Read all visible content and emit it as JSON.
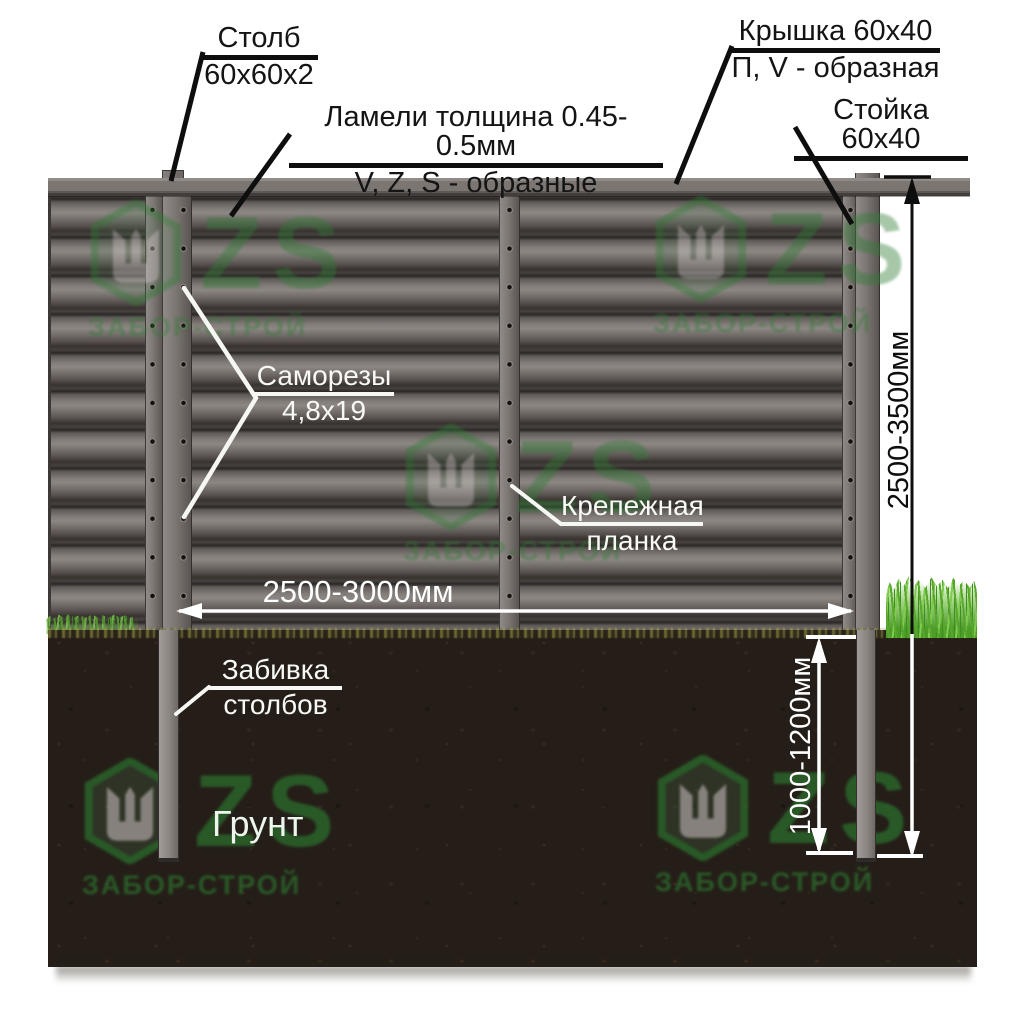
{
  "labels": {
    "stolb": {
      "line1": "Столб",
      "line2": "60х60х2"
    },
    "lameli": {
      "line1": "Ламели толщина 0.45-0.5мм",
      "line2": "V, Z, S - образные"
    },
    "kryshka": {
      "line1": "Крышка 60х40",
      "line2": "П, V - образная"
    },
    "stoyka": {
      "line1": "Стойка 60х40"
    },
    "samorezy": {
      "line1": "Саморезы",
      "line2": "4,8х19"
    },
    "krepezhnaya": {
      "line1": "Крепежная",
      "line2": "планка"
    },
    "zabivka": {
      "line1": "Забивка",
      "line2": "столбов"
    },
    "grunt": "Грунт"
  },
  "dimensions": {
    "panel_width": "2500-3000мм",
    "post_height": "2500-3500мм",
    "post_depth": "1000-1200мм"
  },
  "watermark": {
    "zs": "ZS",
    "brand": "ЗАБОР-СТРОЙ"
  },
  "colors": {
    "accent_green": "#2e7d33",
    "fence_gray": "#7c7673",
    "soil_brown": "#251e18",
    "grass_green": "#58a62c"
  }
}
